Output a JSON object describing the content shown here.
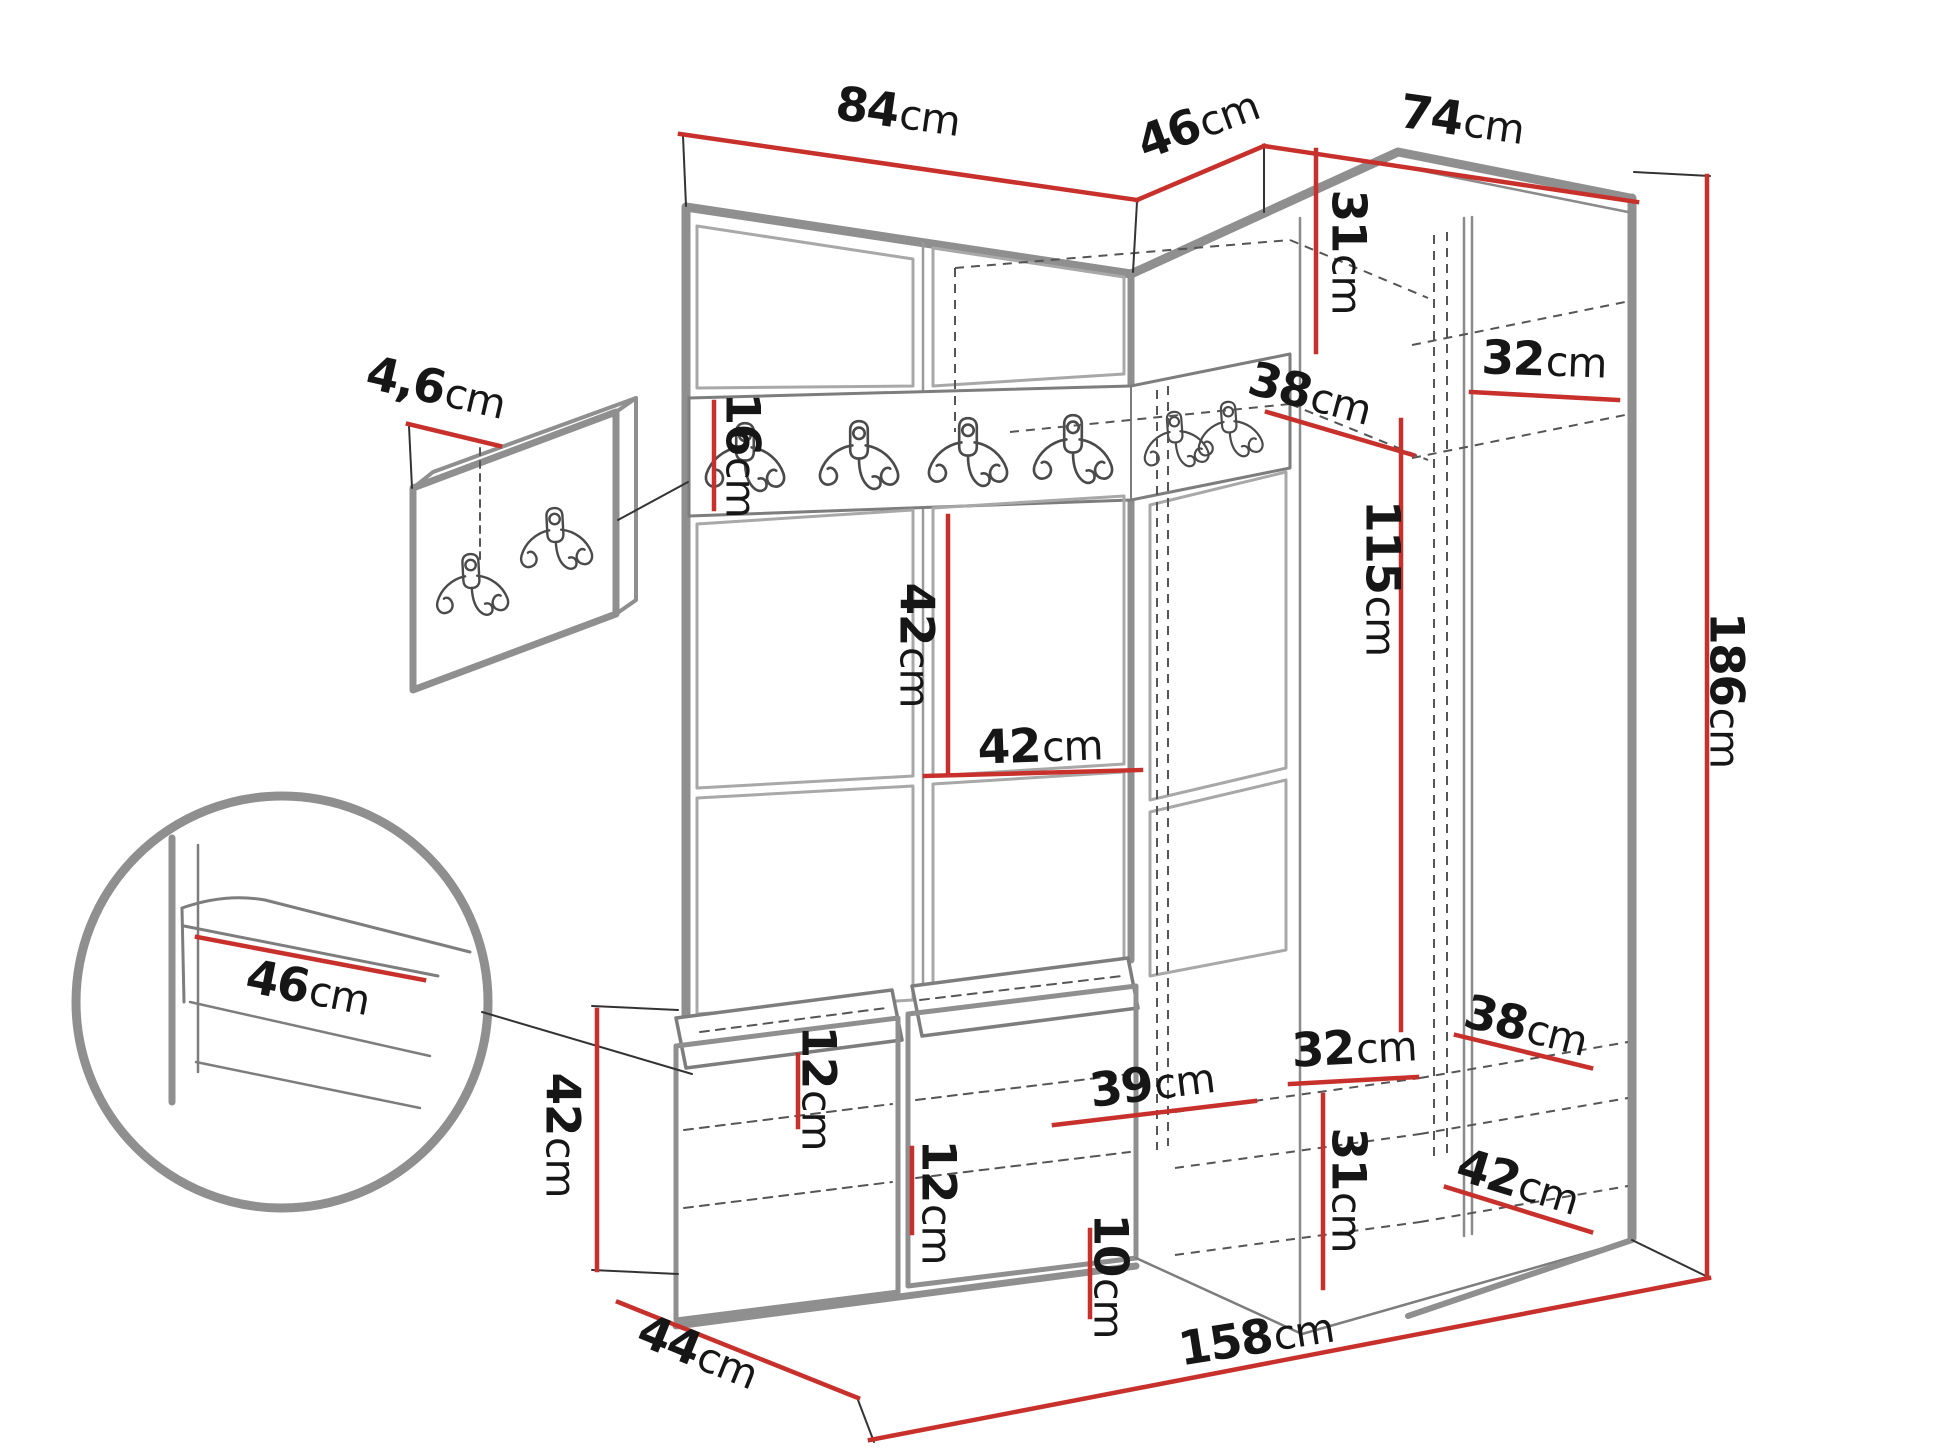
{
  "diagram": {
    "description": "Hallway furniture set technical dimension drawing",
    "dimensions": {
      "d84": {
        "value": "84",
        "unit": "cm"
      },
      "d46top": {
        "value": "46",
        "unit": "cm"
      },
      "d74": {
        "value": "74",
        "unit": "cm"
      },
      "d4_6": {
        "value": "4,6",
        "unit": "cm"
      },
      "d16": {
        "value": "16",
        "unit": "cm"
      },
      "d42v": {
        "value": "42",
        "unit": "cm"
      },
      "d42h": {
        "value": "42",
        "unit": "cm"
      },
      "d31top": {
        "value": "31",
        "unit": "cm"
      },
      "d38top": {
        "value": "38",
        "unit": "cm"
      },
      "d32top": {
        "value": "32",
        "unit": "cm"
      },
      "d115": {
        "value": "115",
        "unit": "cm"
      },
      "d186": {
        "value": "186",
        "unit": "cm"
      },
      "d46detail": {
        "value": "46",
        "unit": "cm"
      },
      "d42bench": {
        "value": "42",
        "unit": "cm"
      },
      "d44": {
        "value": "44",
        "unit": "cm"
      },
      "d12a": {
        "value": "12",
        "unit": "cm"
      },
      "d12b": {
        "value": "12",
        "unit": "cm"
      },
      "d39": {
        "value": "39",
        "unit": "cm"
      },
      "d10": {
        "value": "10",
        "unit": "cm"
      },
      "d32bot": {
        "value": "32",
        "unit": "cm"
      },
      "d31bot": {
        "value": "31",
        "unit": "cm"
      },
      "d38bot": {
        "value": "38",
        "unit": "cm"
      },
      "d42bot": {
        "value": "42",
        "unit": "cm"
      },
      "d158": {
        "value": "158",
        "unit": "cm"
      }
    },
    "hooks": {
      "icon": "coat-hook-icon",
      "rail_hook_count": 6,
      "panel_hook_count": 2
    },
    "colors": {
      "dimension_line": "#c8302c",
      "structure_gray": "#8f8f8f",
      "text": "#161616"
    }
  }
}
